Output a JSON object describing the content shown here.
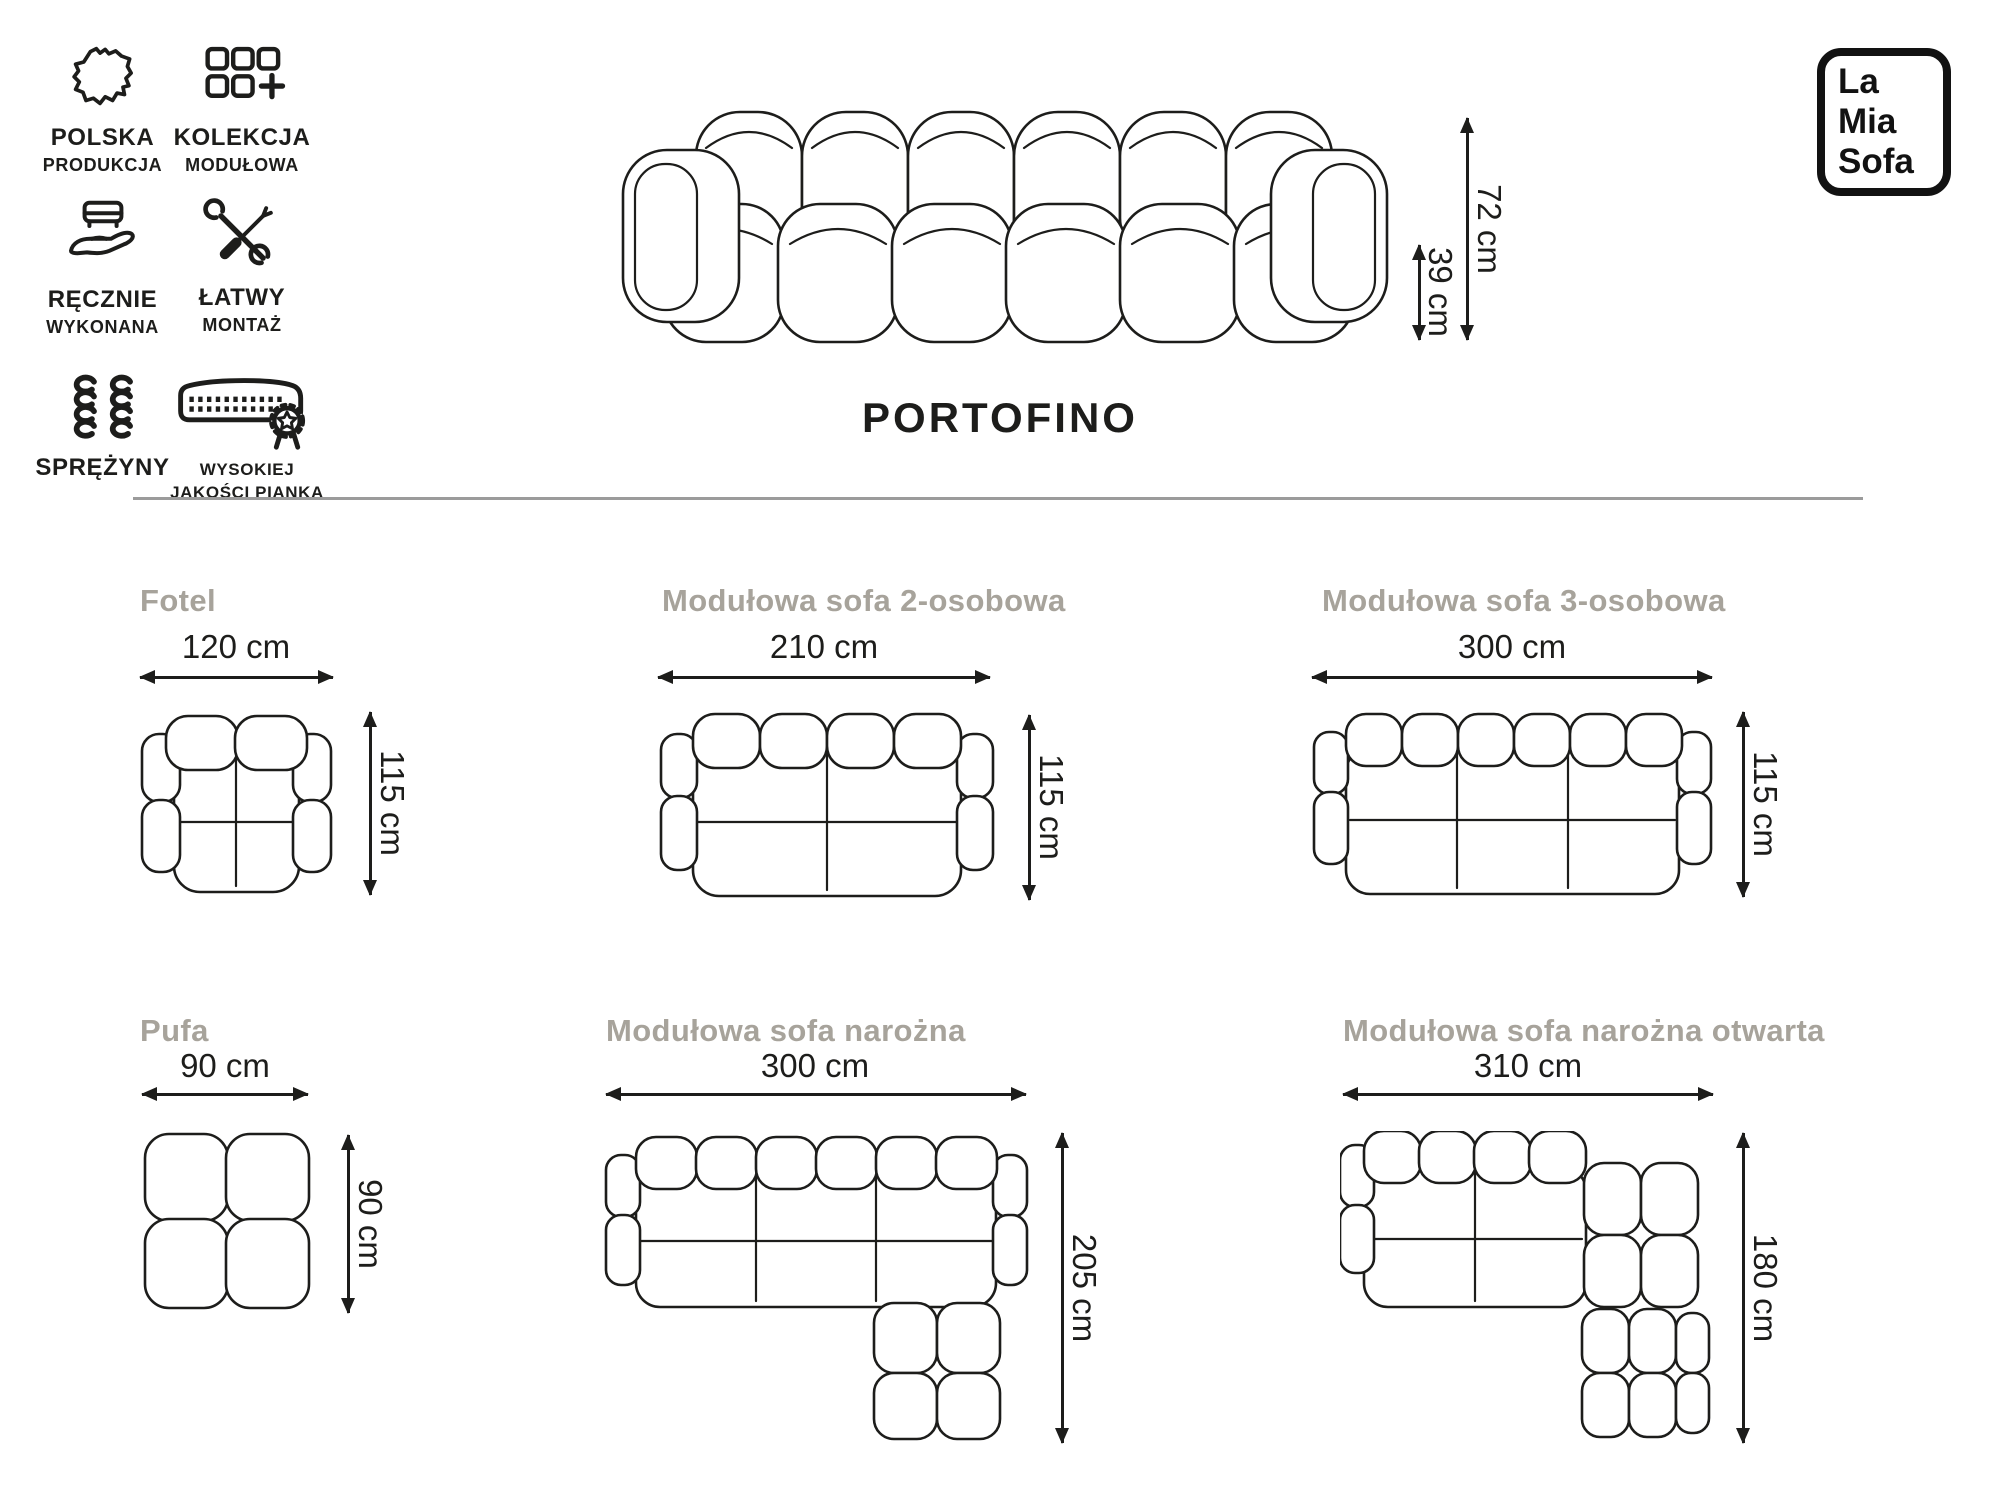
{
  "brand": {
    "name_lines": [
      "La",
      "Mia",
      "Sofa"
    ]
  },
  "header": {
    "features": [
      {
        "icon": "poland-map-icon",
        "label_primary": "POLSKA",
        "label_secondary": "PRODUKCJA"
      },
      {
        "icon": "modular-collection-icon",
        "label_primary": "KOLEKCJA",
        "label_secondary": "MODUŁOWA"
      },
      {
        "icon": "handmade-icon",
        "label_primary": "RĘCZNIE",
        "label_secondary": "WYKONANA"
      },
      {
        "icon": "easy-assembly-icon",
        "label_primary": "ŁATWY",
        "label_secondary": "MONTAŻ"
      },
      {
        "icon": "springs-icon",
        "label_primary": "SPRĘŻYNY",
        "label_secondary": ""
      },
      {
        "icon": "foam-quality-icon",
        "label_primary": "WYSOKIEJ",
        "label_secondary": "JAKOŚCI PIANKA"
      }
    ]
  },
  "product": {
    "name": "PORTOFINO",
    "front_view": {
      "total_height": "72 cm",
      "seat_height": "39 cm"
    }
  },
  "variants": [
    {
      "name": "Fotel",
      "width": "120 cm",
      "depth": "115 cm"
    },
    {
      "name": "Modułowa sofa 2-osobowa",
      "width": "210 cm",
      "depth": "115 cm"
    },
    {
      "name": "Modułowa sofa 3-osobowa",
      "width": "300 cm",
      "depth": "115 cm"
    },
    {
      "name": "Pufa",
      "width": "90 cm",
      "depth": "90 cm"
    },
    {
      "name": "Modułowa sofa narożna",
      "width": "300 cm",
      "depth": "205 cm"
    },
    {
      "name": "Modułowa sofa narożna otwarta",
      "width": "310 cm",
      "depth": "180 cm"
    }
  ],
  "colors": {
    "ink": "#1d1d1b",
    "muted_title": "#a7a39b",
    "divider": "#9b9b9b",
    "background": "#ffffff"
  }
}
